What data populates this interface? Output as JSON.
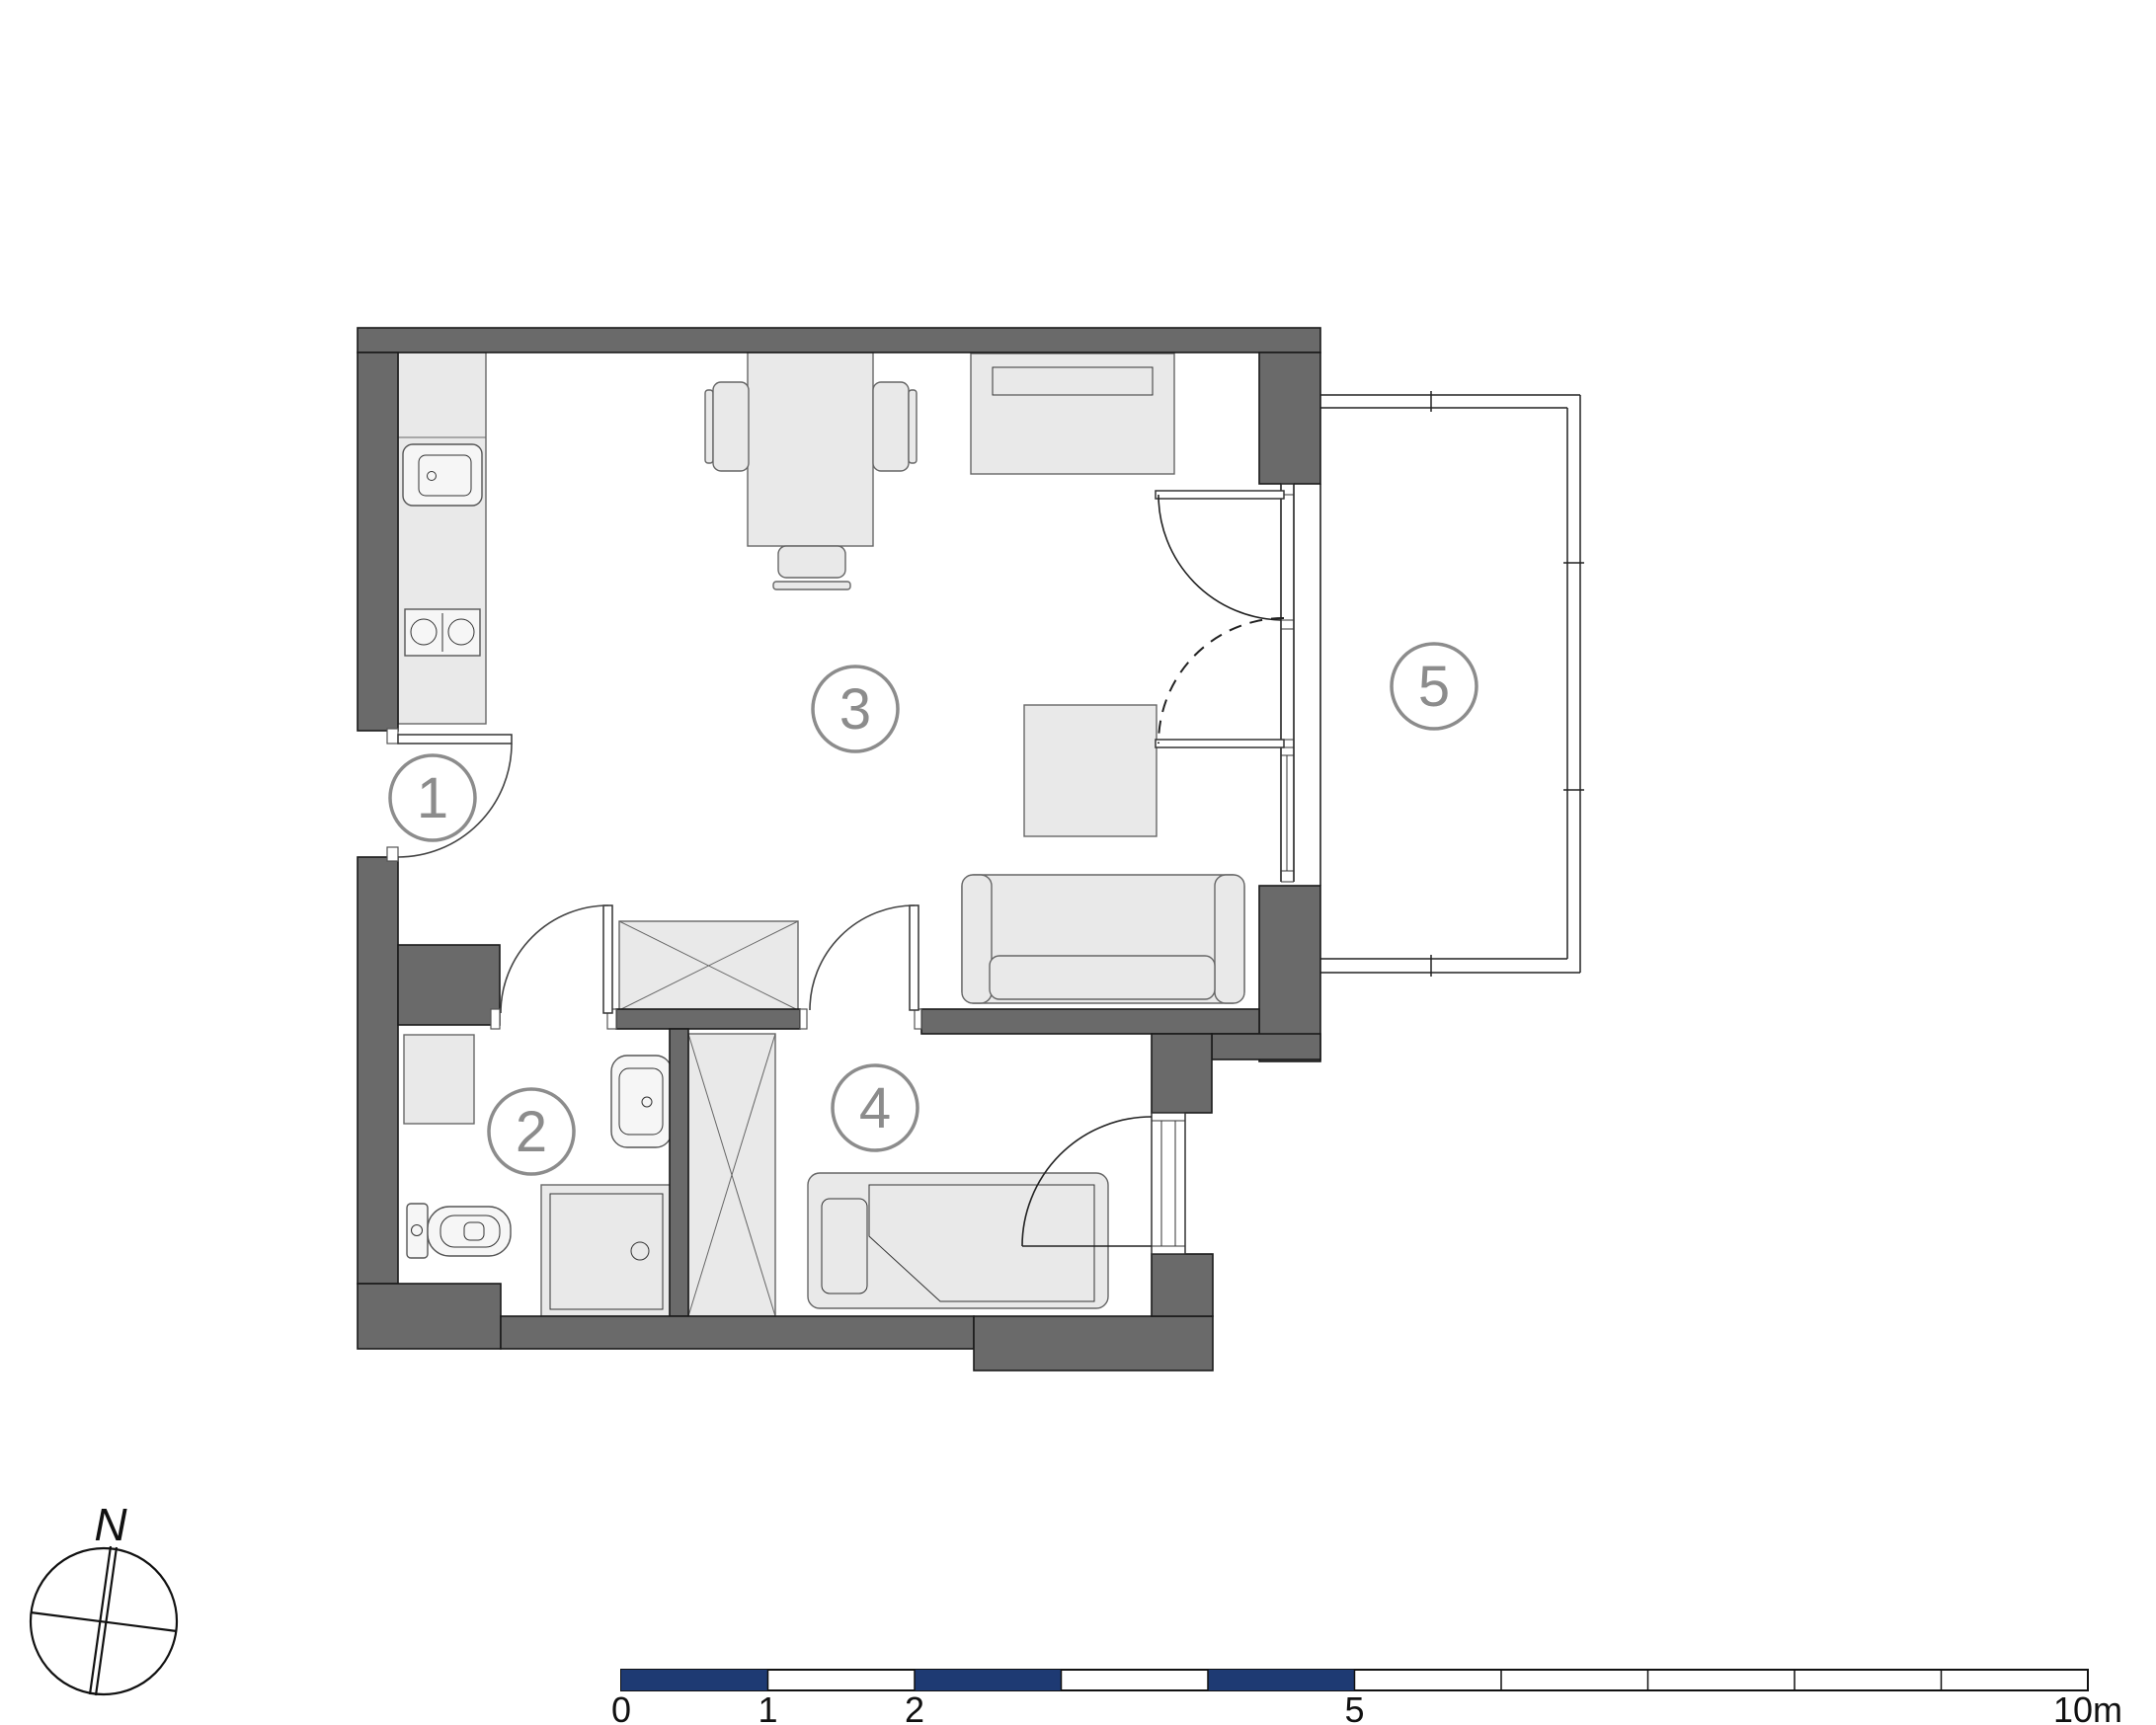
{
  "plan": {
    "rooms": [
      {
        "id": "1",
        "name": "entry-hall"
      },
      {
        "id": "2",
        "name": "bathroom"
      },
      {
        "id": "3",
        "name": "living-room-with-kitchenette"
      },
      {
        "id": "4",
        "name": "bedroom"
      },
      {
        "id": "5",
        "name": "balcony"
      }
    ],
    "fixtures": [
      "kitchen-counter",
      "kitchen-sink",
      "cooktop-two-burners",
      "dining-table",
      "dining-chair",
      "sideboard",
      "coffee-table",
      "sofa",
      "hall-cabinet-crossed",
      "washing-machine",
      "wash-basin",
      "toilet",
      "shower-tray",
      "tall-wardrobe-crossed",
      "single-bed-with-pillow",
      "entry-door",
      "bathroom-door",
      "bedroom-door",
      "balcony-double-door",
      "bedroom-window",
      "balcony-railing"
    ],
    "compass": {
      "north_label": "N"
    },
    "scale_bar": {
      "labels": [
        "0",
        "1",
        "2",
        "5",
        "10m"
      ],
      "label_positions_m": [
        0,
        1,
        2,
        5,
        10
      ],
      "length_m": 10,
      "filled_segments_m": [
        [
          0,
          1
        ],
        [
          2,
          3
        ],
        [
          4,
          5
        ]
      ],
      "open_segments_m": [
        [
          1,
          2
        ],
        [
          3,
          4
        ],
        [
          5,
          6
        ],
        [
          6,
          7
        ],
        [
          7,
          8
        ],
        [
          8,
          9
        ],
        [
          9,
          10
        ]
      ]
    },
    "colors": {
      "wall": "#6a6a6a",
      "furniture": "#e9e9e9",
      "room_label": "#8c8c8c",
      "scale_blue": "#1e3a73",
      "background": "#ffffff"
    }
  }
}
